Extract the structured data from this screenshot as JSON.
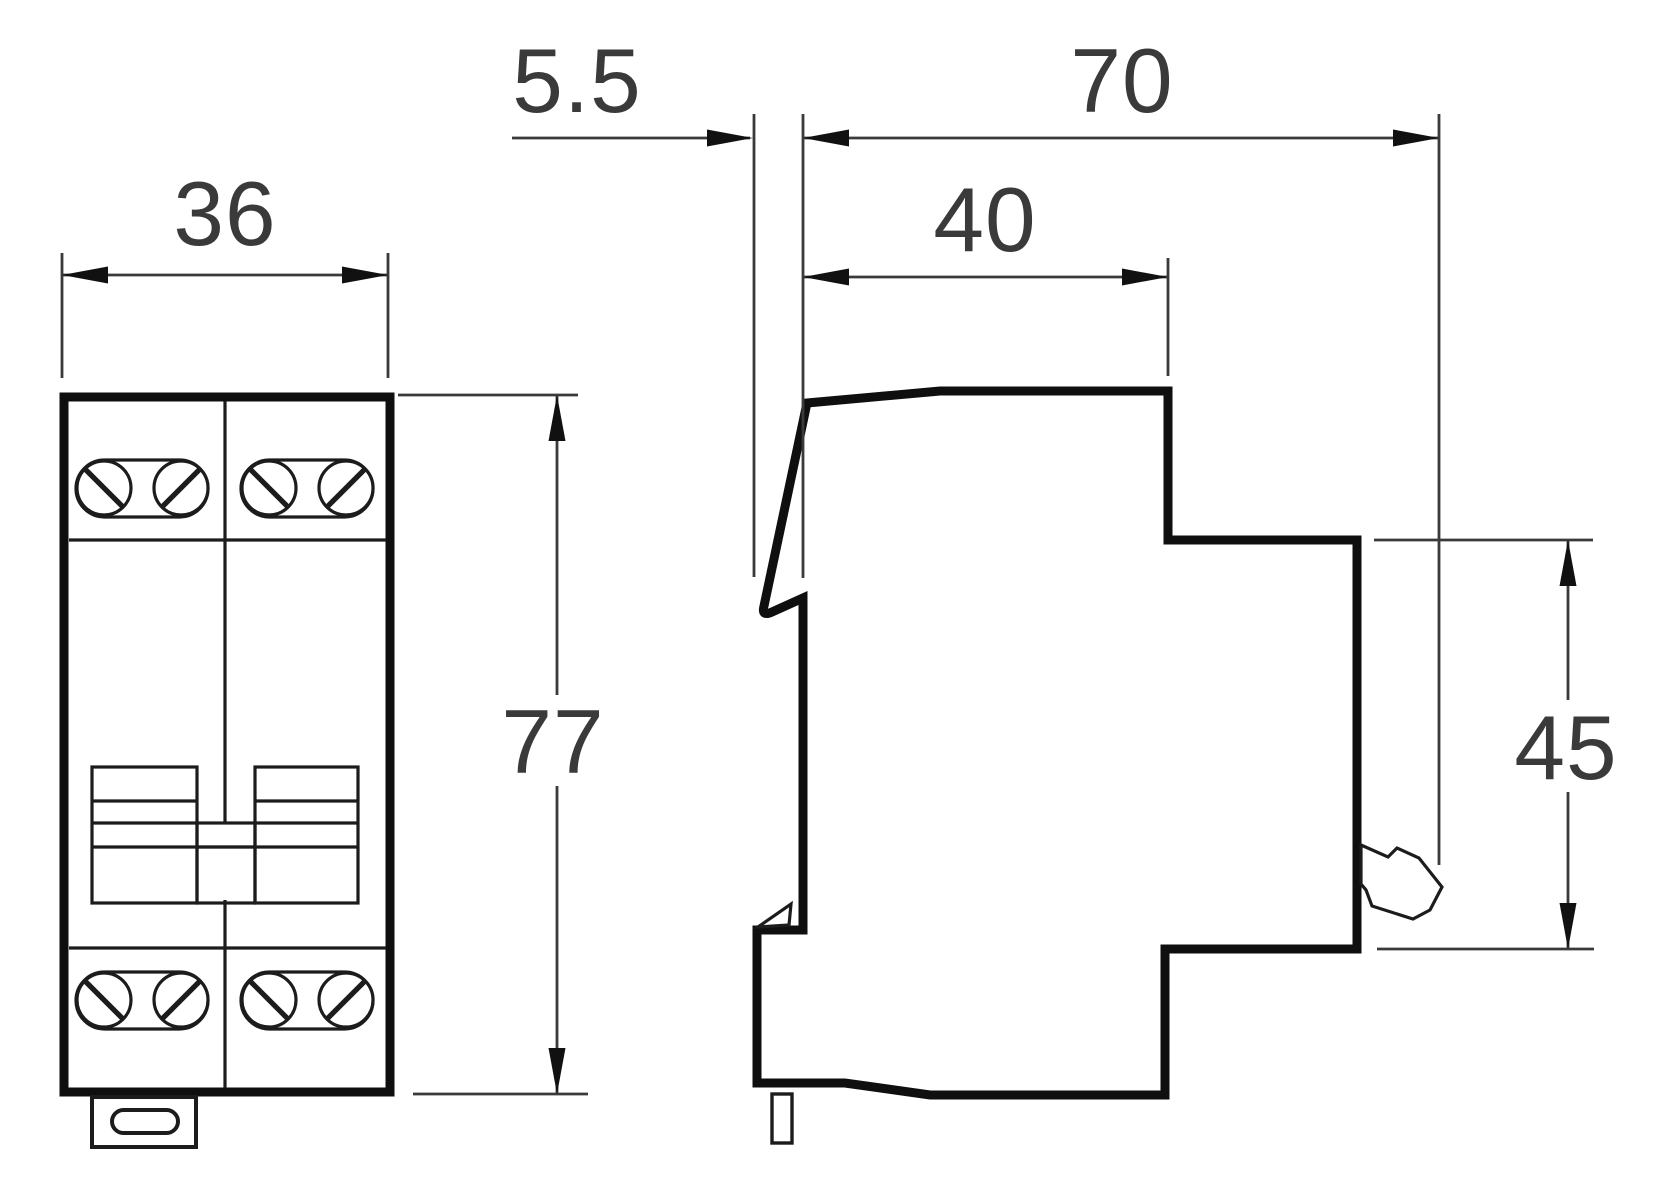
{
  "drawing": {
    "kind": "technical-dimension-drawing",
    "background": "#ffffff",
    "line_color": "#0f0f0f",
    "dimension_color": "#3a3a3a",
    "views": {
      "front_view": "two-module DIN device, front",
      "side_view": "DIN device, side profile"
    },
    "dimensions": {
      "front_width": "36",
      "rail_depth": "5.5",
      "overall_depth": "70",
      "body_depth": "40",
      "overall_height": "77",
      "front_face_height": "45"
    }
  }
}
